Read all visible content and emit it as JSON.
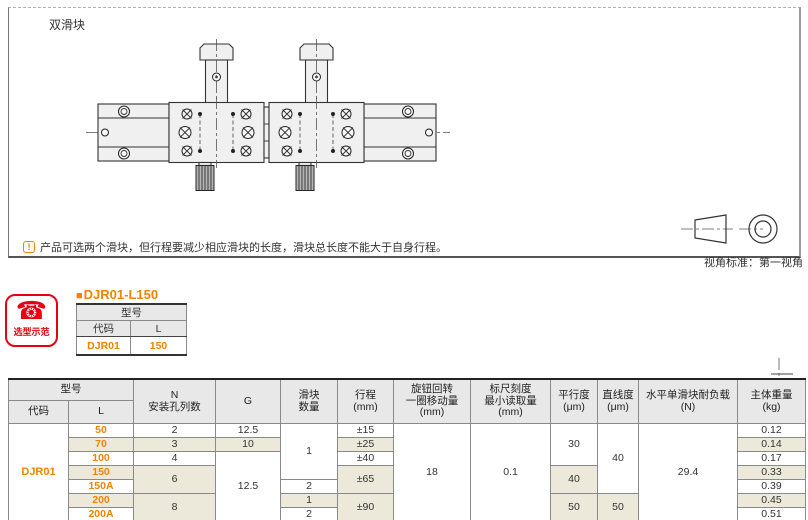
{
  "colors": {
    "accent_orange": "#F08300",
    "brand_red": "#E60012",
    "row_stripe": "#ECE9DA",
    "header_gray": "#E8E8E8"
  },
  "drawing": {
    "variant_label": "双滑块",
    "note_icon": "!",
    "note_text": "产品可选两个滑块，但行程要减少相应滑块的长度，滑块总长度不能大于自身行程。",
    "view_standard_label": "视角标准：第一视角"
  },
  "selection_example": {
    "phone_icon": "☎",
    "badge_label": "选型示范",
    "bullet": "■",
    "title": "DJR01-L150",
    "model_table": {
      "group_header": "型号",
      "col_code": "代码",
      "col_l": "L",
      "code_value": "DJR01",
      "l_value": "150"
    }
  },
  "spec_table": {
    "header": {
      "model_group": "型号",
      "code": "代码",
      "l": "L",
      "n_line1": "N",
      "n_line2": "安装孔列数",
      "g": "G",
      "slider_line1": "滑块",
      "slider_line2": "数量",
      "stroke_line1": "行程",
      "stroke_line2": "(mm)",
      "knob_line1": "旋钮回转",
      "knob_line2": "一圈移动量",
      "knob_line3": "(mm)",
      "scale_line1": "标尺刻度",
      "scale_line2": "最小读取量",
      "scale_line3": "(mm)",
      "parallel_line1": "平行度",
      "parallel_line2": "(μm)",
      "straight_line1": "直线度",
      "straight_line2": "(μm)",
      "load_line1": "水平单滑块耐负载",
      "load_line2": "(N)",
      "weight_line1": "主体重量",
      "weight_line2": "(kg)"
    },
    "code_value": "DJR01",
    "shared": {
      "knob_move_per_turn": "18",
      "scale_min_reading": "0.1",
      "horizontal_load": "29.4"
    },
    "rows": [
      {
        "L": "50",
        "n": "2",
        "g": "12.5",
        "slider": "1",
        "stroke": "±15",
        "parallel": "30",
        "straight": "40",
        "weight": "0.12"
      },
      {
        "L": "70",
        "n": "3",
        "g": "10",
        "stroke": "±25",
        "weight": "0.14"
      },
      {
        "L": "100",
        "n": "4",
        "g": "12.5",
        "stroke": "±40",
        "weight": "0.17"
      },
      {
        "L": "150",
        "n": "6",
        "stroke": "±65",
        "parallel": "40",
        "weight": "0.33"
      },
      {
        "L": "150A",
        "slider": "2",
        "weight": "0.39"
      },
      {
        "L": "200",
        "n": "8",
        "slider": "1",
        "stroke": "±90",
        "parallel": "50",
        "straight": "50",
        "weight": "0.45"
      },
      {
        "L": "200A",
        "slider": "2",
        "weight": "0.51"
      }
    ]
  }
}
